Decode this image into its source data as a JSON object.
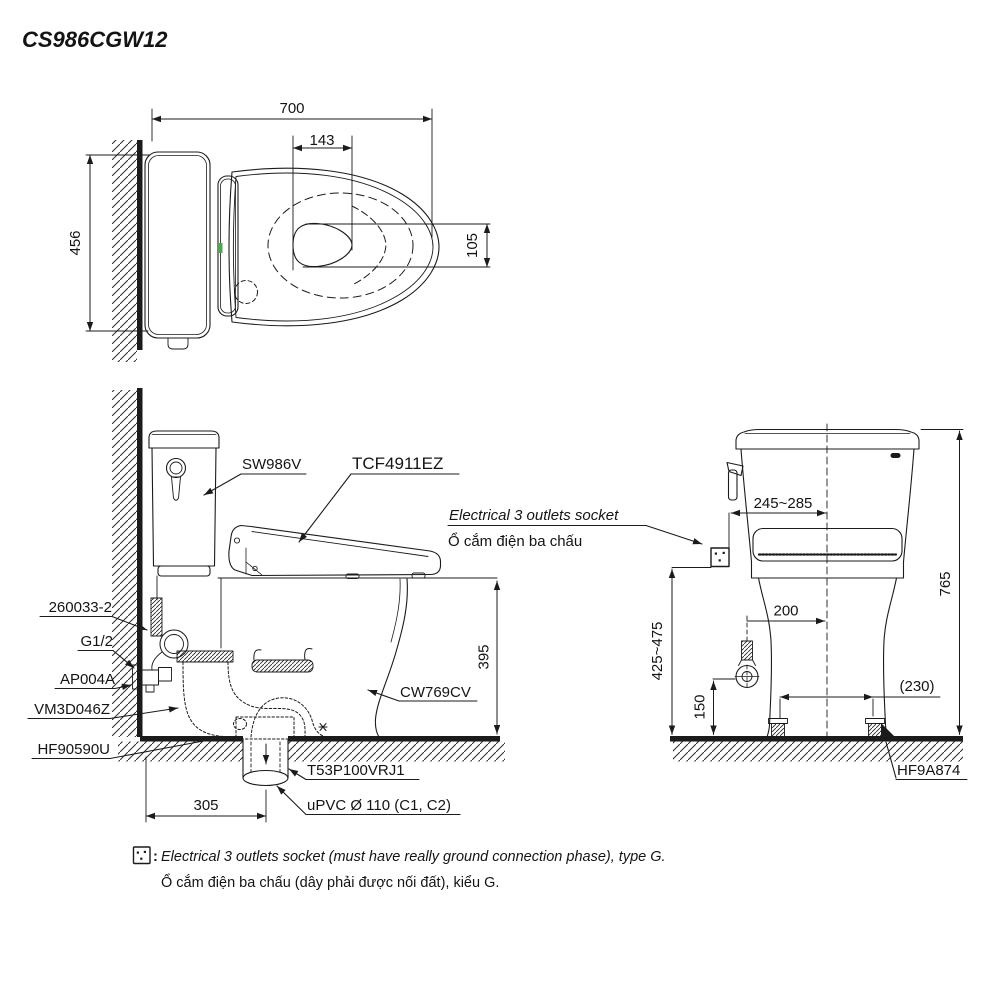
{
  "title": "CS986CGW12",
  "top_view": {
    "dim_width": "700",
    "dim_seat_hole_width": "143",
    "dim_depth": "456",
    "dim_water_surface": "105"
  },
  "side_view": {
    "label_tank": "SW986V",
    "label_washlet": "TCF4911EZ",
    "label_supply_hose": "260033-2",
    "label_thread": "G1/2",
    "label_angle_valve": "AP004A",
    "label_seal": "VM3D046Z",
    "label_fixing": "HF90590U",
    "label_bowl": "CW769CV",
    "label_flange": "T53P100VRJ1",
    "label_drain_pipe": "uPVC Ø 110 (C1, C2)",
    "dim_rim_height": "395",
    "dim_outlet_from_wall": "305"
  },
  "socket_callout": {
    "line_en": "Electrical 3 outlets socket",
    "line_vi": "Ổ cắm điện ba chấu"
  },
  "front_view": {
    "dim_socket_offset": "245~285",
    "dim_supply_offset": "200",
    "dim_total_height": "765",
    "dim_socket_height": "425~475",
    "dim_valve_height": "150",
    "dim_bolt_spacing": "(230)",
    "label_bolt_kit": "HF9A874"
  },
  "footer": {
    "colon": ":",
    "line_en": "Electrical 3 outlets socket (must have really ground connection phase), type G.",
    "line_vi": "Ổ cắm điện ba chấu (dây phải được nối đất), kiểu G."
  }
}
